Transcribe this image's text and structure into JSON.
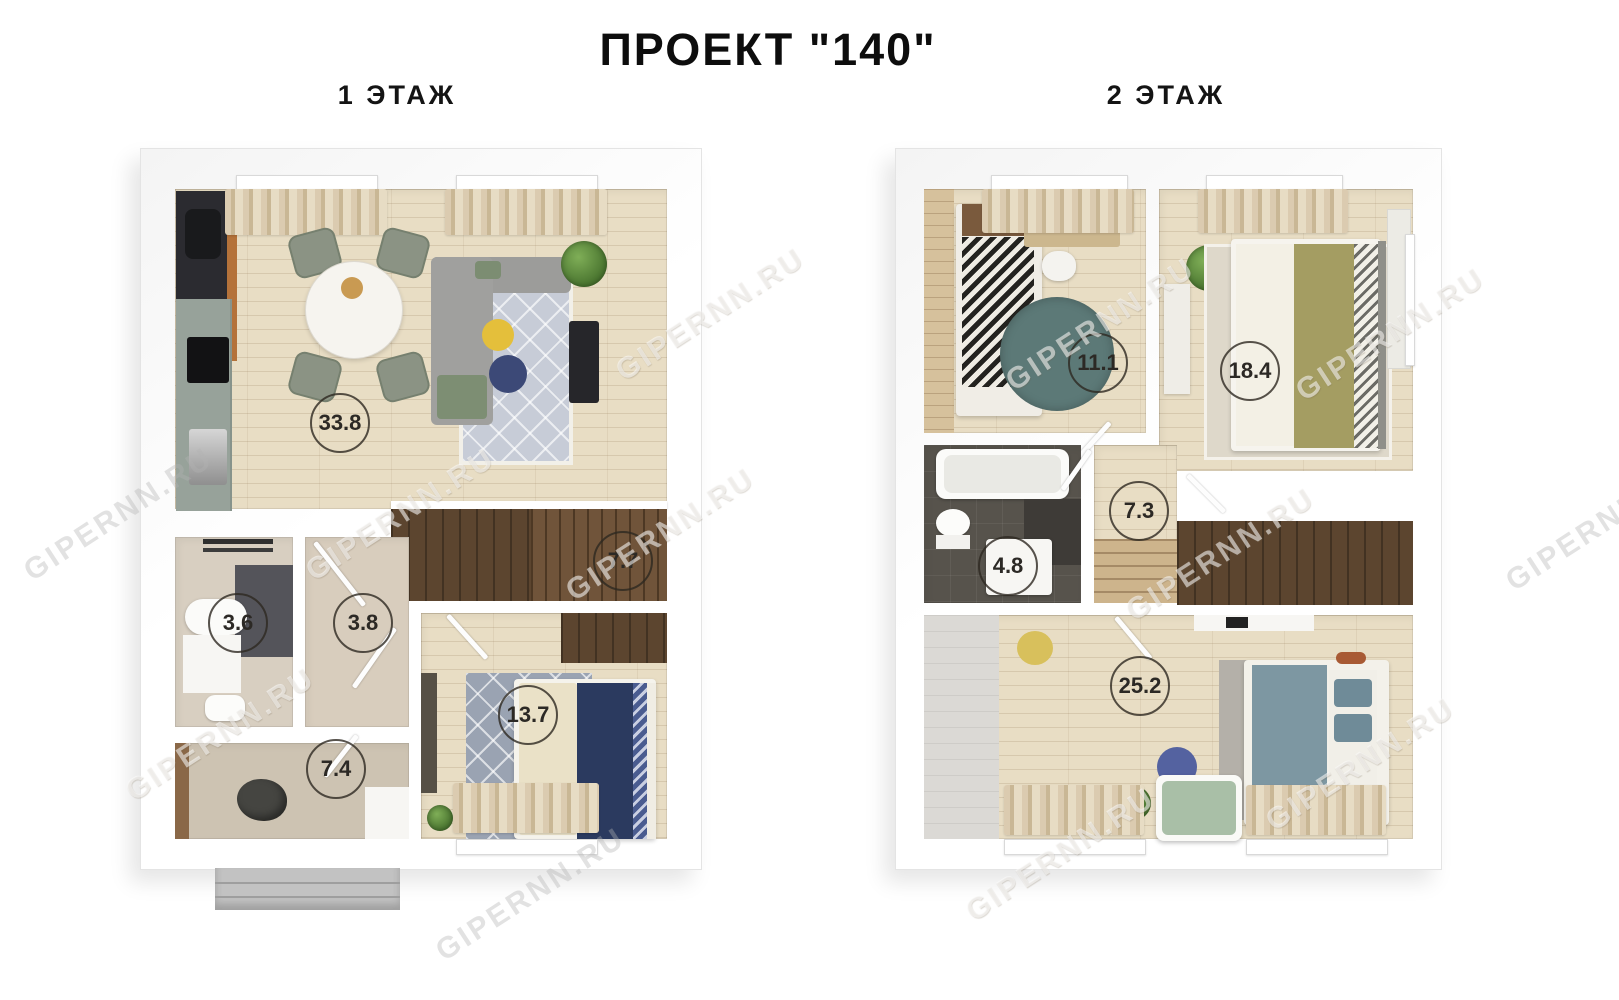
{
  "title": "ПРОЕКТ \"140\"",
  "watermark": "GIPERNN.RU",
  "floor1": {
    "label": "1 ЭТАЖ",
    "areas": {
      "living_kitchen": "33.8",
      "stairs": "7.7",
      "bathroom": "3.6",
      "hall": "3.8",
      "utility": "7.4",
      "bedroom": "13.7"
    }
  },
  "floor2": {
    "label": "2 ЭТАЖ",
    "areas": {
      "room": "11.1",
      "bedroom": "18.4",
      "hall": "7.3",
      "bathroom": "4.8",
      "master_bedroom": "25.2"
    }
  }
}
